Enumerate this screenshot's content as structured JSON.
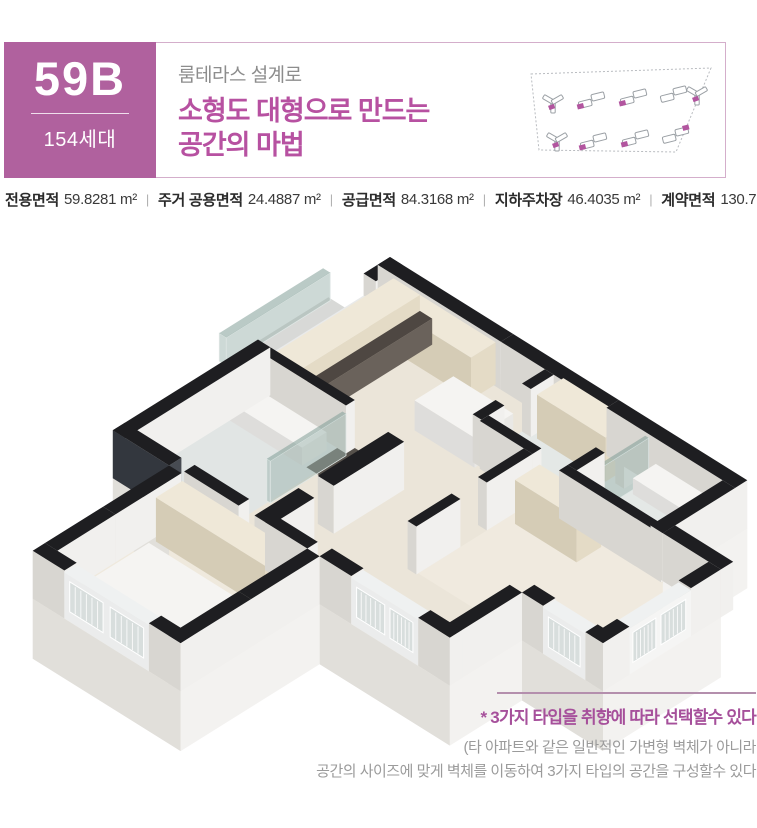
{
  "header": {
    "unit_code": "59B",
    "unit_count": "154세대",
    "subtitle": "룸테라스 설계로",
    "title_line1": "소형도 대형으로 만드는",
    "title_line2": "공간의 마법"
  },
  "specs": {
    "separator": "|",
    "items": [
      {
        "label": "전용면적",
        "value": "59.8281 m²"
      },
      {
        "label": "주거 공용면적",
        "value": "24.4887 m²"
      },
      {
        "label": "공급면적",
        "value": "84.3168 m²"
      },
      {
        "label": "지하주차장",
        "value": "46.4035 m²"
      },
      {
        "label": "계약면적",
        "value": "130.7204 m²"
      }
    ]
  },
  "caption": {
    "highlight": "* 3가지 타입을 취향에 따라 선택할수 있다",
    "line1": "(타 아파트와 같은 일반적인 가변형 벽체가 아니라",
    "line2": "공간의 사이즈에 맞게 벽체를 이동하여 3가지 타입의 공간을 구성할수 있다"
  },
  "colors": {
    "accent_purple": "#b0619e",
    "title_purple": "#b751a1",
    "caption_purple": "#a6509b",
    "rule_mauve": "#b48fad",
    "border_pink": "#d4aecb",
    "gray_text": "#9b9b9b",
    "spec_text": "#2b2b2b",
    "wall_black": "#1e1e21",
    "floor_wood": "#ebe5d9",
    "site_highlight": "#b2559f"
  },
  "icons": {
    "bullet": "*"
  }
}
